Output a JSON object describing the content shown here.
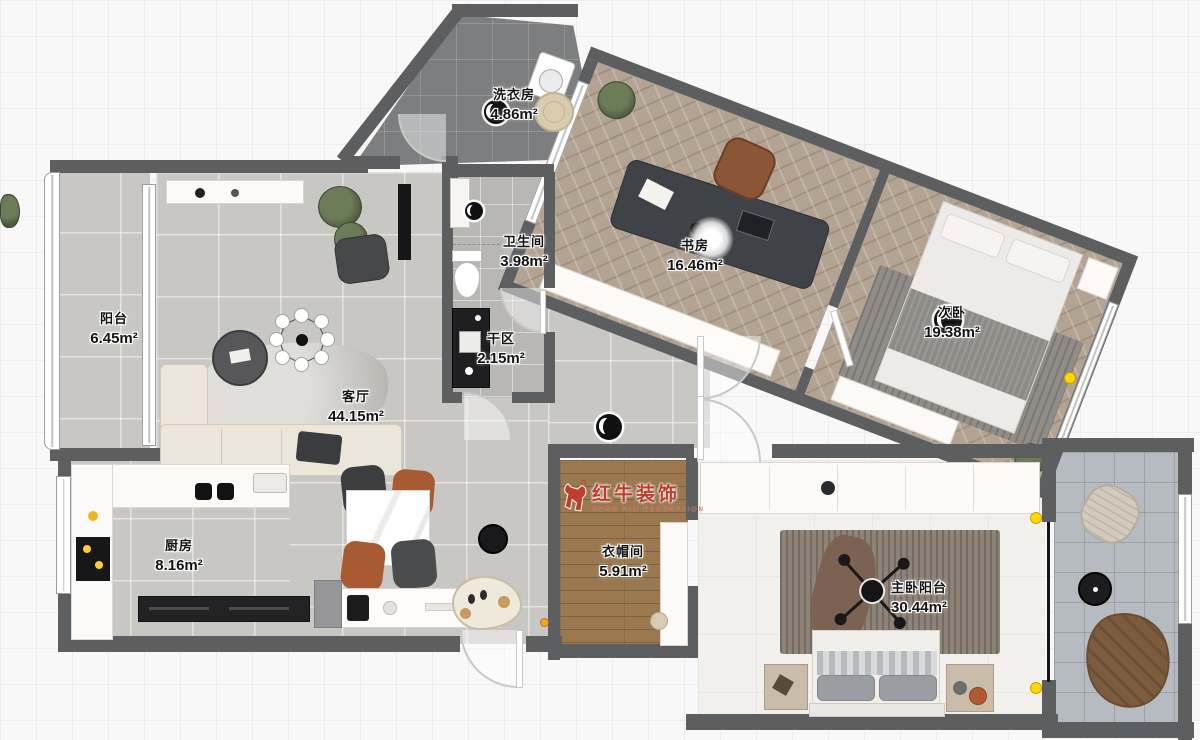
{
  "canvas": {
    "width": 1200,
    "height": 740,
    "bg": "#f8f8f9",
    "grid_color": "#ededf0"
  },
  "palette": {
    "wall": "#5d5e60",
    "black_wall": "#161618",
    "gray_tile": "#c9c7c4",
    "dark_tile": "#7d7e80",
    "herringbone_wood": "#b3a392",
    "plank_wood": "#9a7950",
    "white_floor": "#f2f0ec",
    "balcony_tile": "#b6bbc1",
    "marker_yellow": "#ffd900",
    "watermark_red": "#c13b2a",
    "chair_rust": "#a85a32",
    "chair_black": "#3c3e40"
  },
  "watermark": {
    "logo": "bull-icon",
    "name": "红牛装饰",
    "subtitle": "HONG NIU DECORATION"
  },
  "rooms": [
    {
      "key": "laundry",
      "name": "洗衣房",
      "area": "4.86m²"
    },
    {
      "key": "bathroom",
      "name": "卫生间",
      "area": "3.98m²"
    },
    {
      "key": "dry_area",
      "name": "干区",
      "area": "2.15m²"
    },
    {
      "key": "study",
      "name": "书房",
      "area": "16.46m²"
    },
    {
      "key": "second_bedroom",
      "name": "次卧",
      "area": "19.38m²"
    },
    {
      "key": "balcony",
      "name": "阳台",
      "area": "6.45m²"
    },
    {
      "key": "living_room",
      "name": "客厅",
      "area": "44.15m²"
    },
    {
      "key": "kitchen",
      "name": "厨房",
      "area": "8.16m²"
    },
    {
      "key": "cloakroom",
      "name": "衣帽间",
      "area": "5.91m²"
    },
    {
      "key": "master_suite",
      "name": "主卧阳台",
      "area": "30.44m²"
    }
  ]
}
